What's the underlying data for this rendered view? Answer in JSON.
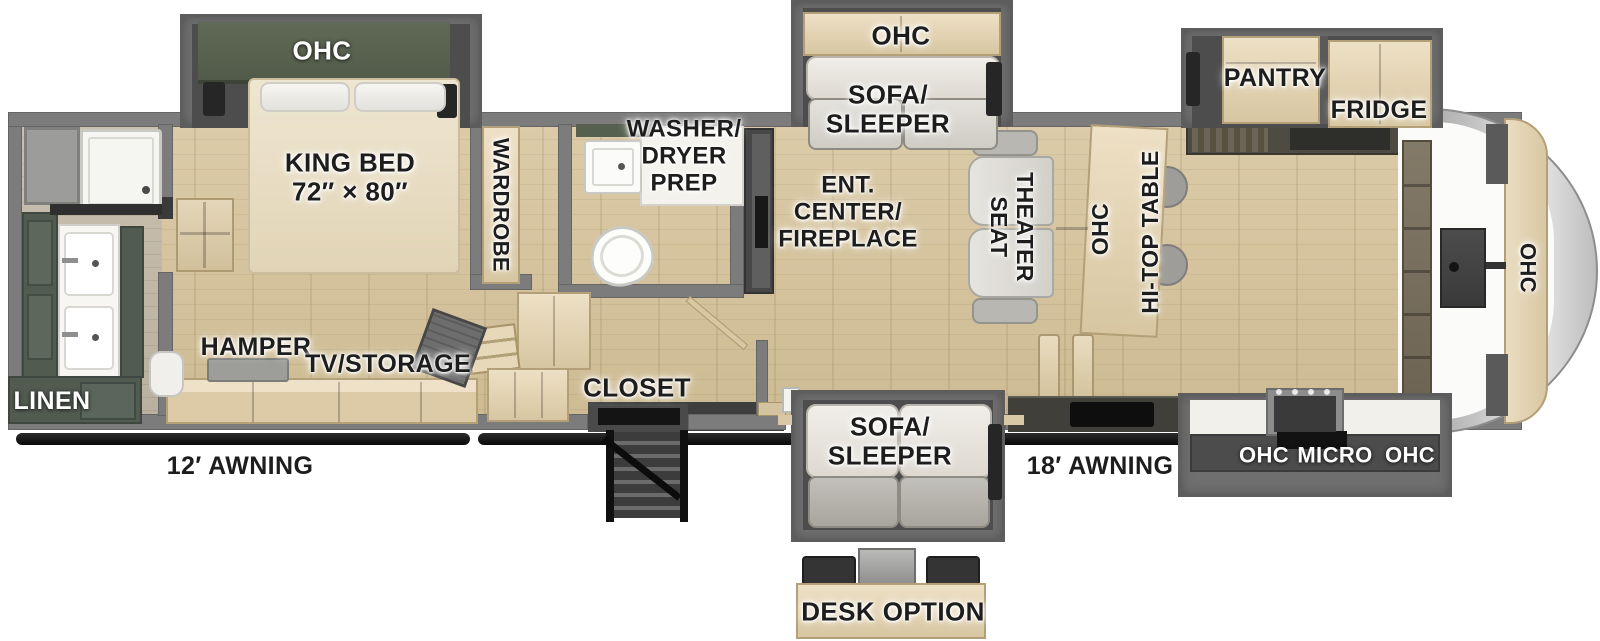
{
  "colors": {
    "floor_wood": "#d3c2a0",
    "wall_gray": "#7c7c7c",
    "slide_gray": "#6f6f6f",
    "cabinet_green": "#515b50",
    "ohc_dark_green": "#59614f",
    "cabinet_wood": "#e2d3b2",
    "awning_black": "#151515",
    "label_dark": "#1d1d1d",
    "label_light": "#ffffff"
  },
  "labels": {
    "bedroom_ohc": "OHC",
    "king_bed": "KING BED\n72″ × 80″",
    "wardrobe": "WARDROBE",
    "linen": "LINEN",
    "hamper": "HAMPER",
    "tv_storage": "TV/STORAGE",
    "washer_dryer_prep": "WASHER/\nDRYER\nPREP",
    "closet": "CLOSET",
    "sofa_top_ohc": "OHC",
    "sofa_top": "SOFA/\nSLEEPER",
    "ent_center": "ENT.\nCENTER/\nFIREPLACE",
    "theater_seat": "THEATER\nSEAT",
    "dinette_ohc": "OHC",
    "hi_top_table": "HI-TOP TABLE",
    "pantry": "PANTRY",
    "fridge": "FRIDGE",
    "front_ohc": "OHC",
    "sofa_bottom": "SOFA/\nSLEEPER",
    "desk_option": "DESK OPTION",
    "kitchen_ohc_left": "OHC",
    "kitchen_micro": "MICRO",
    "kitchen_ohc_right": "OHC",
    "awning_left": "12′ AWNING",
    "awning_right": "18′ AWNING"
  }
}
